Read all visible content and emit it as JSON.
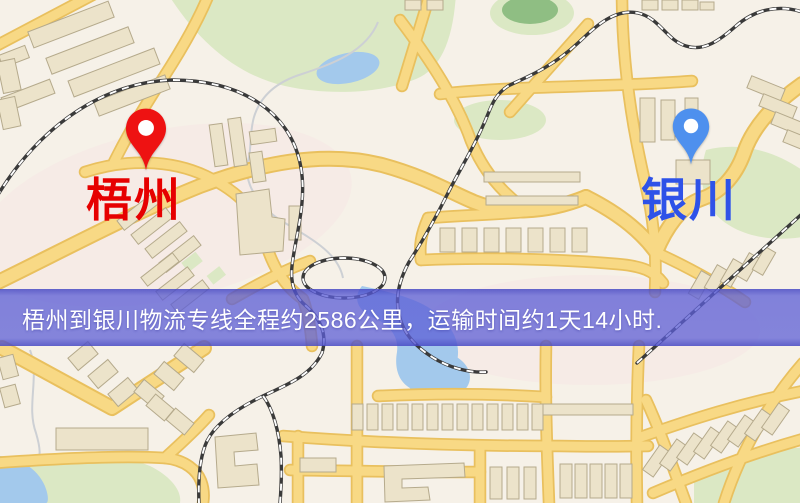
{
  "banner": {
    "text": "梧州到银川物流专线全程约2586公里，运输时间约1天14小时.",
    "background_color": "#5c5ed6",
    "text_color": "#ffffff",
    "route": {
      "origin": "梧州",
      "destination": "银川",
      "distance_km": "2586",
      "duration": "1天14小时"
    }
  },
  "markers": {
    "origin": {
      "name": "梧州",
      "pin_color": "#ee1212",
      "label_color": "#e60000"
    },
    "destination": {
      "name": "银川",
      "pin_color": "#4e90ee",
      "label_color": "#2e52e8"
    }
  }
}
